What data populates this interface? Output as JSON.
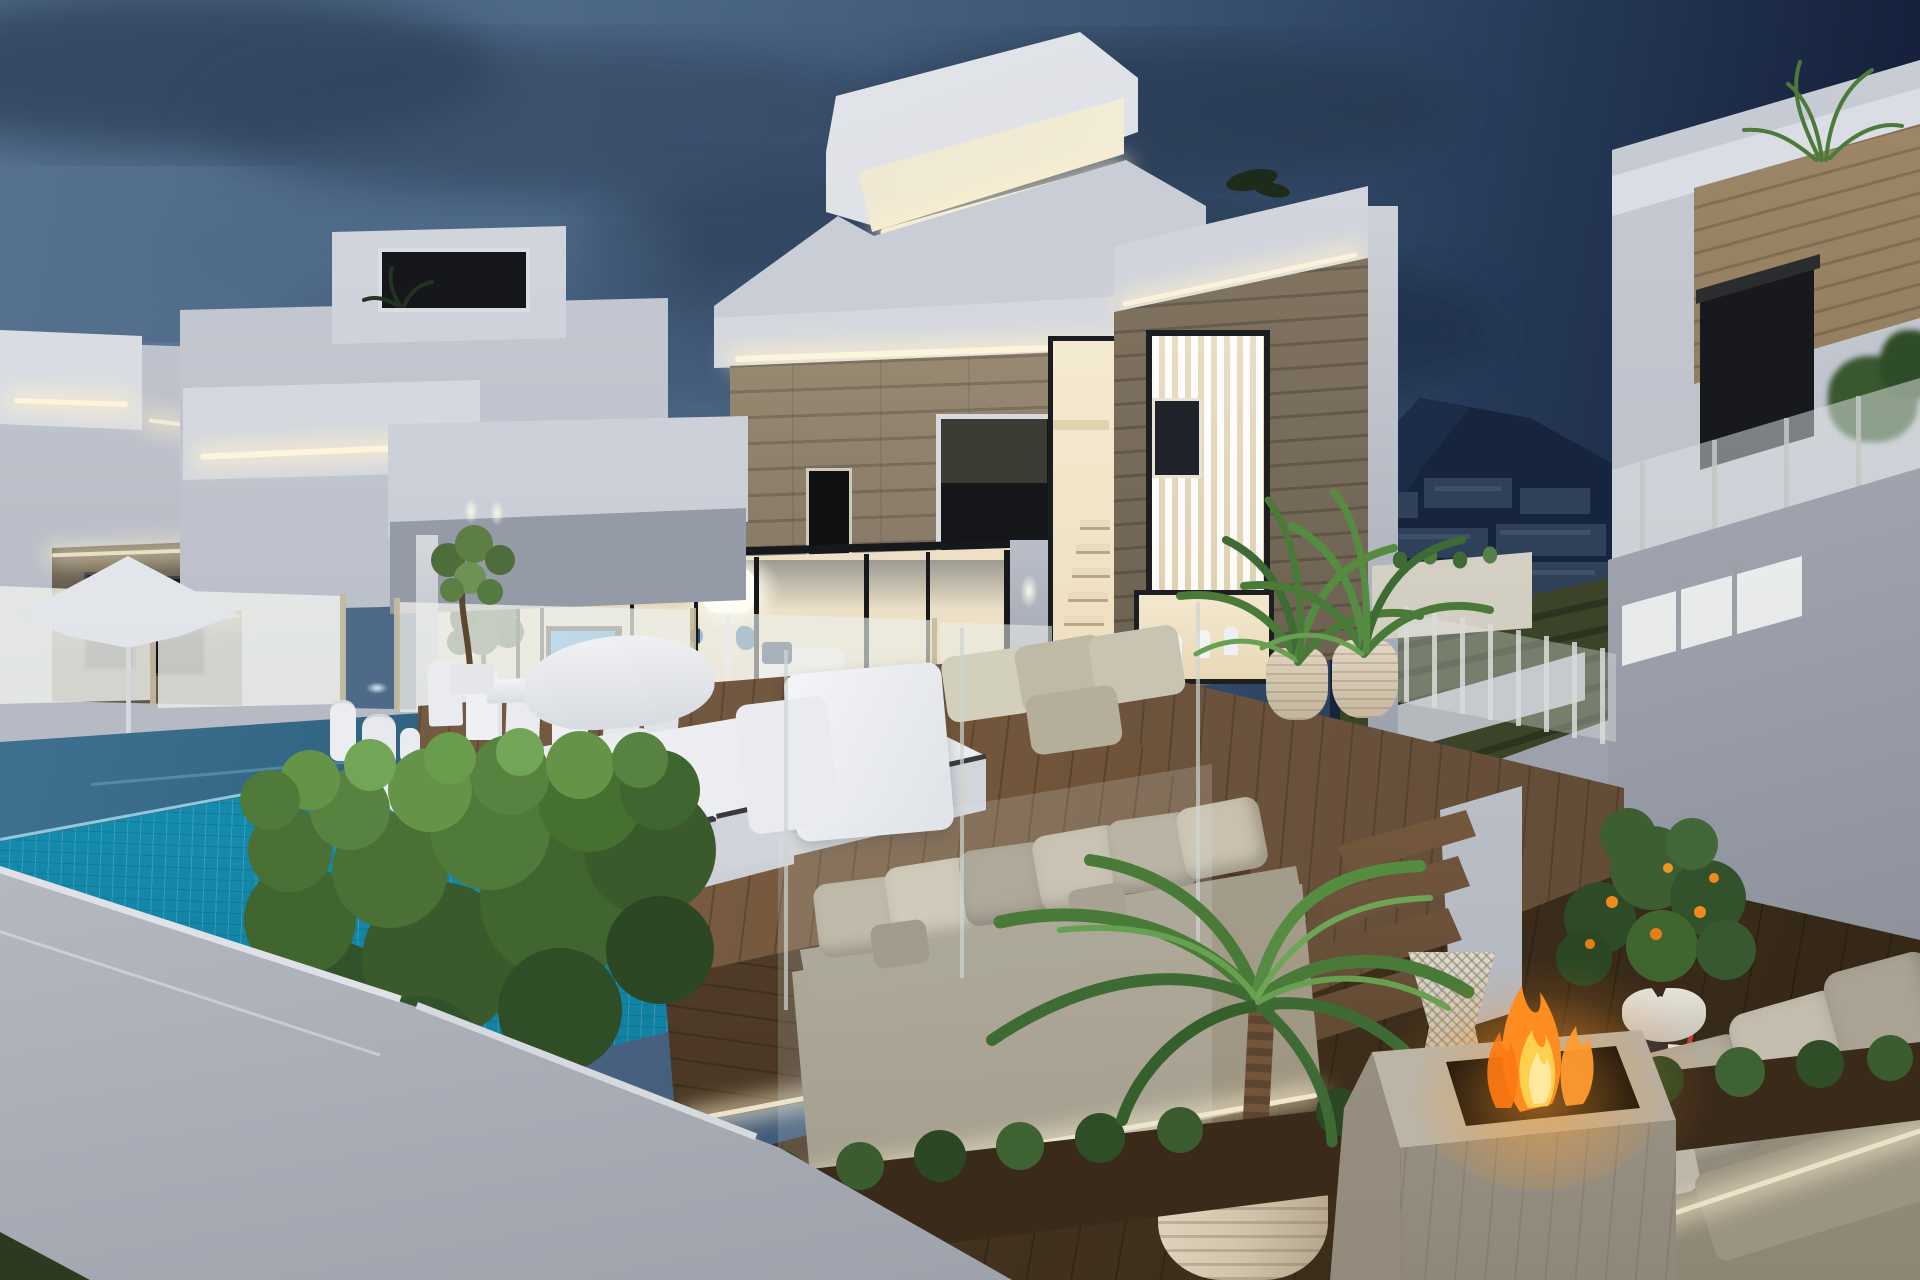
{
  "scene": {
    "description": "3D architectural rendering of modern white cubic villas at dusk with infinity pool, wooden deck terraces, outdoor lounge furniture and fire pit",
    "time_of_day": "dusk",
    "weather": "partly cloudy evening sky"
  },
  "palette": {
    "sky_blue": "#4a6585",
    "sky_light_patch": "#8aa6bf",
    "sky_dark_right": "#131f38",
    "cloud_dark": "#2b3d55",
    "villa_white_bright": "#e2e5ea",
    "villa_white": "#c6cad3",
    "villa_white_shadow": "#a9aeb9",
    "stone_light": "#a4937b",
    "stone_dark": "#5d5346",
    "window_dark": "#14161a",
    "interior_warm": "#f2e8d2",
    "led_warm": "#fff3d2",
    "pool_tile": "#1a9fc2",
    "pool_water_dark": "#0d3a55",
    "deck_wood": "#6f563f",
    "terrace_wood_dark": "#43331f",
    "hedge_green": "#4f7239",
    "shrub_green": "#3a5c2f",
    "sofa_beige": "#b6ac9a",
    "cushion_light": "#ccc3b0",
    "pot_beige": "#d9cbb4",
    "fire_orange": "#ff8c1e",
    "fire_yellow": "#ffd04e",
    "mountain_navy": "#16253d",
    "town_silhouette": "#2e4158",
    "terraced_field_olive": "#3b4429",
    "glass_frost": "rgba(240,243,240,0.78)",
    "tv_screen_blue": "#1f86d8",
    "boundary_wall": "#c3c6cd"
  },
  "objects": [
    "dusk-sky",
    "clouds",
    "mountain-with-town",
    "terraced-hillside",
    "left-villa",
    "middle-villa",
    "main-villa",
    "right-villa",
    "rooftop-light-box",
    "led-cove-strips",
    "stone-clad-facade",
    "glass-sliding-doors",
    "tv-screen",
    "floor-lamp",
    "indoor-staircase",
    "stair-window",
    "kitchen-window",
    "bar-stools",
    "vertical-blinds-window",
    "glass-balustrade",
    "patio-umbrella",
    "outdoor-dining-set",
    "olive-tree",
    "white-lanterns",
    "infinity-pool",
    "pool-mosaic-wall",
    "wooden-deck",
    "white-daybeds",
    "potted-palms",
    "palm-in-ribbed-pot",
    "boxwood-hedge",
    "outdoor-sofa-left",
    "outdoor-sofa-right",
    "fire-pit",
    "wicker-stool",
    "rattan-coffee-table",
    "citrus-tree-pot",
    "wooden-steps",
    "shrub-border",
    "white-boundary-wall",
    "roof-plants",
    "planter-succulents"
  ]
}
